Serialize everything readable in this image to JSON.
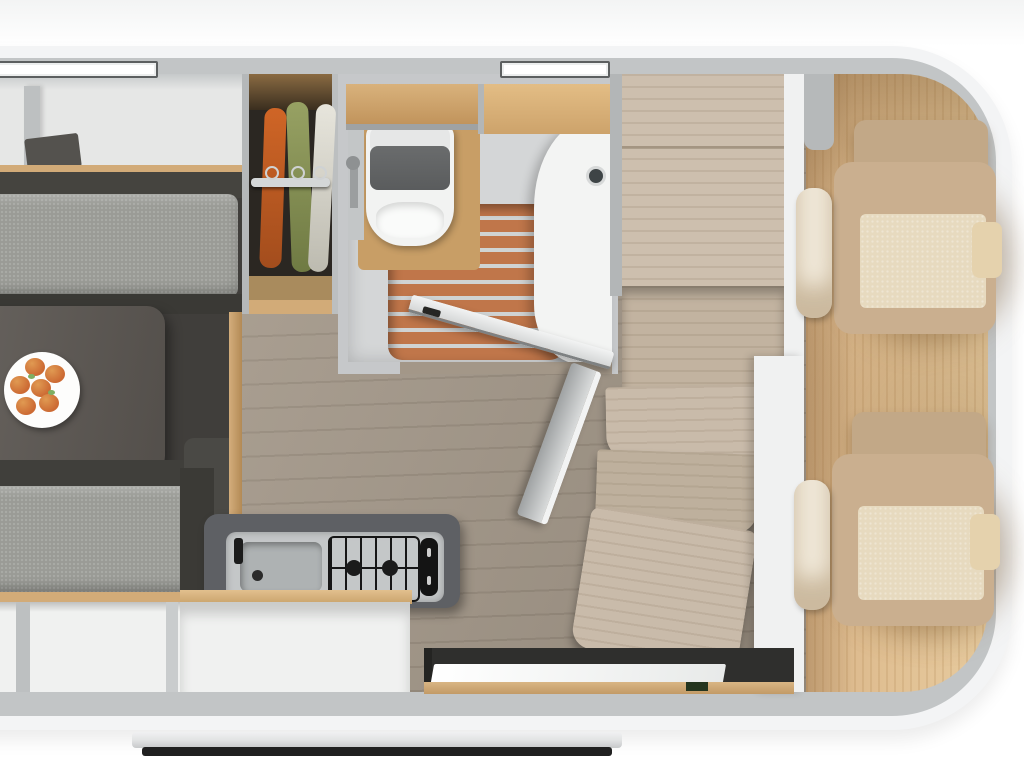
{
  "meta": {
    "description": "Top-down 3D rendered floor plan of a campervan / motorhome interior, white studio background",
    "view": "overhead plan render",
    "visible_text": "none"
  },
  "colors": {
    "bg": "#ffffff",
    "shell": "#f3f4f5",
    "wall": "#c2c5c6",
    "floor_wood": "#a39788",
    "floor_plank_line": "#968a7b",
    "lounge_base": "#403e3b",
    "shelf_light": "#e6e7e6",
    "shelf_shadow": "#c6c9ca",
    "divider": "#bdc0c1",
    "wood_trim": "#d2ab78",
    "bench_back": "#45443f",
    "bench2_back": "#403f3b",
    "bench_cushion": "#9a9b96",
    "bench_front": "#3a3935",
    "table": "#615c57",
    "plate": "#fdfdfc",
    "fruit": "#cc6a33",
    "fruit_light": "#e09a52",
    "leaf": "#7fae62",
    "wardrobe_dark": "#2b2722",
    "cloth_orange": "#cf6526",
    "cloth_green": "#97a163",
    "cloth_white": "#e7e5dc",
    "rail_gray": "#d4d7d8",
    "bath_wall": "#c6c8ca",
    "bath_floor": "#d4d6d7",
    "bath_wood": "#d9b27c",
    "teak": "#c0764a",
    "teak_slat": "#d0d3d3",
    "toilet_white": "#f2f3f2",
    "toilet_seat": "#5a5c5d",
    "sink_white": "#f3f4f3",
    "counter_dark": "#5e6064",
    "kit_unit": "#c4c7c8",
    "kit_sink": "#aeb2b3",
    "kit_black": "#161616",
    "cabinet_white": "#f0f1f0",
    "platform_wood": "#cdbfae",
    "step_wood": "#c9bbaa",
    "step_wood2": "#beb09d",
    "white_wall": "#f0f1f1",
    "cab_floor": "#e0bf92",
    "seat_beige": "#caaf8f",
    "seat_back": "#c2a887",
    "seat_center": "#e7dabf",
    "seat_arm": "#f0e8d8",
    "entry_dark": "#2f2f2d",
    "threshold": "#c29a66",
    "rail_silver": "#e2e3e4",
    "rail_dark": "#202020"
  },
  "scene": {
    "vehicle": {
      "type": "campervan floor plan",
      "body": "white rounded shell, cab at right, rear at left (cropped at left edge)",
      "roof_windows": [
        "left roof window",
        "center roof window"
      ],
      "exterior_step_rail": "silver bar below body"
    },
    "rear_lounge": {
      "overhead_shelf_top": "open white compartments with divider and wood trim",
      "bench_seats": 2,
      "cushion_color_name": "speckled gray",
      "table": {
        "color_name": "dark gray",
        "items": [
          {
            "name": "fruit plate",
            "fruit_count": 6,
            "fruit_color_name": "orange"
          }
        ]
      },
      "lower_shelf": "open white compartments along bottom wall"
    },
    "wardrobe": {
      "interior": "dark",
      "hanging_rail": true,
      "garments": [
        {
          "color_name": "orange"
        },
        {
          "color_name": "sage green"
        },
        {
          "color_name": "white"
        }
      ]
    },
    "bathroom": {
      "fixtures": [
        "toilet with dark seat",
        "hand sprayer",
        "white curved washbasin with faucet",
        "shower floor with teak slats"
      ],
      "overhead_wood_shelves": 2,
      "door_state": "open, swung into hallway, dark handle"
    },
    "kitchen": {
      "countertop_color_name": "dark gray",
      "fixtures": [
        "sink with black faucet",
        "gas hob with black grate",
        "black control panel with two knobs"
      ],
      "cabinet": "white front with wood top edge"
    },
    "mid_cabin": {
      "floor": "gray-brown wood laminate planks",
      "platforms": "large wood platform with seam plus lower platform",
      "steps": 3,
      "leaning_board": "gray panel leaning against steps"
    },
    "cab": {
      "floor": "light beige wood, vertical grain",
      "seats": 2,
      "seat_color_name": "beige with light center panels and white armrests"
    },
    "entry_door": {
      "state": "open",
      "panel": "white sliding panel",
      "threshold": "wood strip",
      "position": "bottom wall"
    }
  }
}
